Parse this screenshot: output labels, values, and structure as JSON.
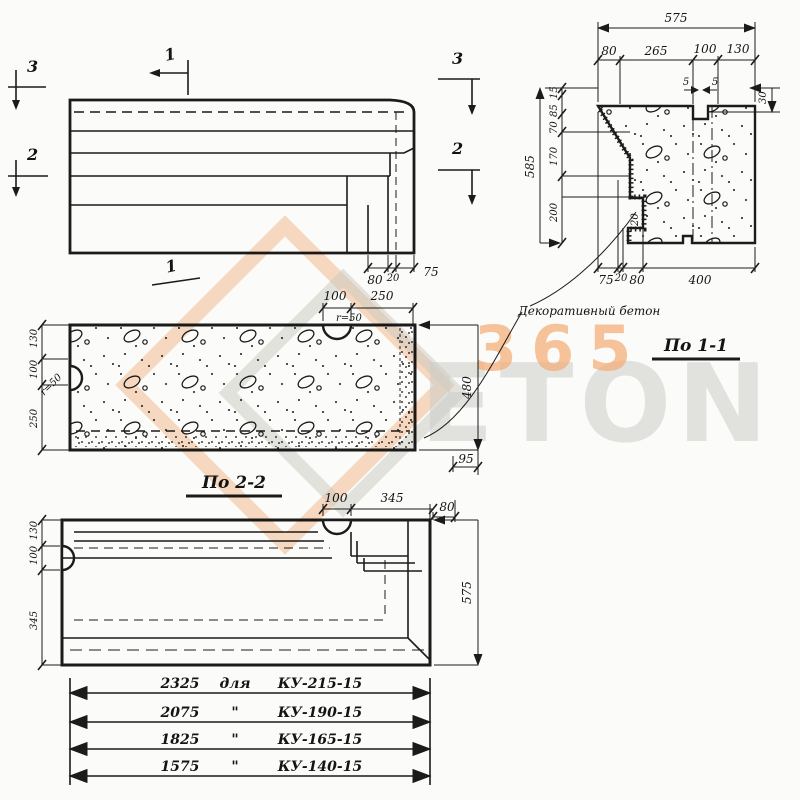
{
  "watermark": {
    "number": "365",
    "word": "ETON"
  },
  "marks": {
    "m3_left": "3",
    "m2_left": "2",
    "m1_top": "1",
    "m1_bottom": "1",
    "m3_right": "3",
    "m2_right": "2"
  },
  "elevation": {
    "dim_80": "80",
    "dim_20": "20",
    "dim_75": "75"
  },
  "section11": {
    "title": "По 1-1",
    "note": "Декоративный бетон",
    "total_w": "575",
    "w1": "80",
    "w2": "265",
    "w3": "100",
    "w4": "130",
    "g1": "5",
    "g2": "5",
    "right_30": "30",
    "total_h": "585",
    "h1": "15",
    "h2": "85",
    "h3": "70",
    "h4": "170",
    "h5": "200",
    "b1": "75",
    "b2": "20",
    "b3": "80",
    "b4": "400",
    "inner_20": "20"
  },
  "plan22": {
    "title": "По 2-2",
    "t1": "100",
    "t2": "250",
    "r_top": "r=50",
    "r_left": "r=50",
    "l1": "130",
    "l2": "100",
    "l3": "250",
    "right_480": "480",
    "gap_95": "95"
  },
  "planb": {
    "t1": "100",
    "t2": "345",
    "r80": "80",
    "r575": "575",
    "l1": "130",
    "l2": "100",
    "l3": "345"
  },
  "table": {
    "rows": [
      {
        "len": "2325",
        "sep": "для",
        "mark": "КУ-215-15"
      },
      {
        "len": "2075",
        "sep": "\"",
        "mark": "КУ-190-15"
      },
      {
        "len": "1825",
        "sep": "\"",
        "mark": "КУ-165-15"
      },
      {
        "len": "1575",
        "sep": "\"",
        "mark": "КУ-140-15"
      }
    ]
  }
}
